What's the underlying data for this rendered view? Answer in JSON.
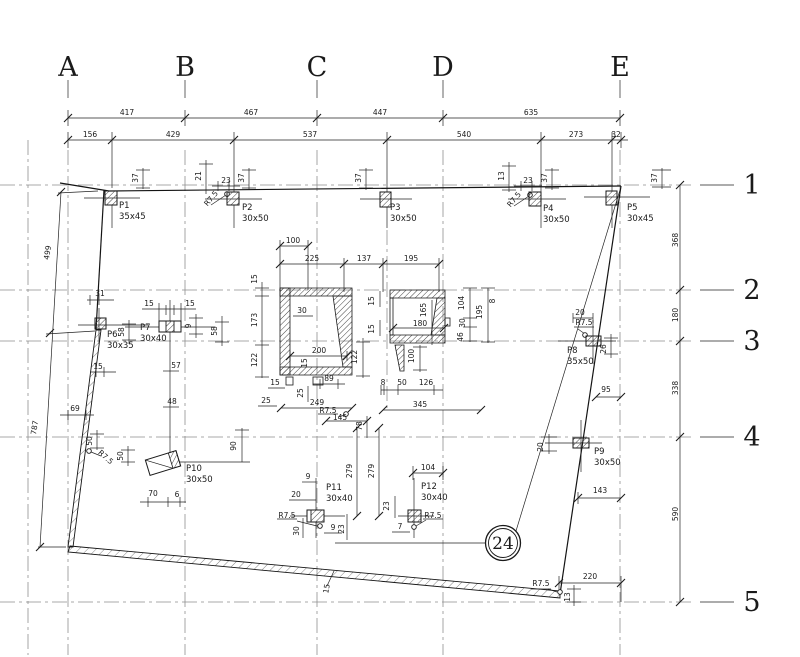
{
  "sheet": {
    "type_label": "structural column layout plan"
  },
  "grid": {
    "columns": [
      {
        "label": "A",
        "x": 68
      },
      {
        "label": "B",
        "x": 185
      },
      {
        "label": "C",
        "x": 317
      },
      {
        "label": "D",
        "x": 443
      },
      {
        "label": "E",
        "x": 620
      }
    ],
    "rows": [
      {
        "label": "1",
        "y": 185
      },
      {
        "label": "2",
        "y": 290
      },
      {
        "label": "3",
        "y": 341
      },
      {
        "label": "4",
        "y": 437
      },
      {
        "label": "5",
        "y": 602
      }
    ]
  },
  "detail_marker": {
    "label": "24",
    "x": 503,
    "y": 543
  },
  "columns": [
    {
      "id": "P1",
      "size": "35x45",
      "x": 119,
      "y": 208
    },
    {
      "id": "P2",
      "size": "30x50",
      "x": 242,
      "y": 210
    },
    {
      "id": "P3",
      "size": "30x50",
      "x": 390,
      "y": 210
    },
    {
      "id": "P4",
      "size": "30x50",
      "x": 543,
      "y": 211
    },
    {
      "id": "P5",
      "size": "30x45",
      "x": 627,
      "y": 210
    },
    {
      "id": "P6",
      "size": "30x35",
      "x": 107,
      "y": 337
    },
    {
      "id": "P7",
      "size": "30x40",
      "x": 140,
      "y": 330
    },
    {
      "id": "P8",
      "size": "35x50",
      "x": 567,
      "y": 353
    },
    {
      "id": "P9",
      "size": "30x50",
      "x": 594,
      "y": 454
    },
    {
      "id": "P10",
      "size": "30x50",
      "x": 186,
      "y": 471
    },
    {
      "id": "P11",
      "size": "30x40",
      "x": 326,
      "y": 490
    },
    {
      "id": "P12",
      "size": "30x40",
      "x": 421,
      "y": 489
    }
  ],
  "dim_labels": [
    {
      "t": "417",
      "x": 127,
      "y": 115
    },
    {
      "t": "467",
      "x": 251,
      "y": 115
    },
    {
      "t": "447",
      "x": 380,
      "y": 115
    },
    {
      "t": "635",
      "x": 531,
      "y": 115
    },
    {
      "t": "156",
      "x": 90,
      "y": 137
    },
    {
      "t": "429",
      "x": 173,
      "y": 137
    },
    {
      "t": "537",
      "x": 310,
      "y": 137
    },
    {
      "t": "540",
      "x": 464,
      "y": 137
    },
    {
      "t": "273",
      "x": 576,
      "y": 137
    },
    {
      "t": "32",
      "x": 616,
      "y": 137
    },
    {
      "t": "37",
      "x": 138,
      "y": 178,
      "r": -90
    },
    {
      "t": "21",
      "x": 201,
      "y": 176,
      "r": -90
    },
    {
      "t": "23",
      "x": 226,
      "y": 183
    },
    {
      "t": "R7.5",
      "x": 213,
      "y": 200,
      "r": -50
    },
    {
      "t": "37",
      "x": 244,
      "y": 178,
      "r": -90
    },
    {
      "t": "37",
      "x": 361,
      "y": 178,
      "r": -90
    },
    {
      "t": "13",
      "x": 504,
      "y": 176,
      "r": -90
    },
    {
      "t": "23",
      "x": 528,
      "y": 183
    },
    {
      "t": "R7.5",
      "x": 516,
      "y": 201,
      "r": -50
    },
    {
      "t": "37",
      "x": 547,
      "y": 178,
      "r": -90
    },
    {
      "t": "37",
      "x": 657,
      "y": 178,
      "r": -90
    },
    {
      "t": "499",
      "x": 50,
      "y": 253,
      "r": -81
    },
    {
      "t": "787",
      "x": 37,
      "y": 428,
      "r": -81
    },
    {
      "t": "31",
      "x": 100,
      "y": 296
    },
    {
      "t": "58",
      "x": 124,
      "y": 332,
      "r": -90
    },
    {
      "t": "15",
      "x": 149,
      "y": 306
    },
    {
      "t": "15",
      "x": 190,
      "y": 306
    },
    {
      "t": "9",
      "x": 191,
      "y": 326,
      "r": -90
    },
    {
      "t": "58",
      "x": 217,
      "y": 331,
      "r": -90
    },
    {
      "t": "57",
      "x": 176,
      "y": 368
    },
    {
      "t": "48",
      "x": 172,
      "y": 404
    },
    {
      "t": "15",
      "x": 98,
      "y": 369
    },
    {
      "t": "69",
      "x": 75,
      "y": 411
    },
    {
      "t": "50",
      "x": 92,
      "y": 441,
      "r": -90
    },
    {
      "t": "R7.5",
      "x": 104,
      "y": 459,
      "r": 42
    },
    {
      "t": "50",
      "x": 123,
      "y": 456,
      "r": -90
    },
    {
      "t": "90",
      "x": 236,
      "y": 446,
      "r": -90
    },
    {
      "t": "70",
      "x": 153,
      "y": 496
    },
    {
      "t": "6",
      "x": 177,
      "y": 497
    },
    {
      "t": "100",
      "x": 293,
      "y": 243
    },
    {
      "t": "225",
      "x": 312,
      "y": 261
    },
    {
      "t": "137",
      "x": 364,
      "y": 261
    },
    {
      "t": "195",
      "x": 411,
      "y": 261
    },
    {
      "t": "15",
      "x": 257,
      "y": 279,
      "r": -90
    },
    {
      "t": "173",
      "x": 257,
      "y": 320,
      "r": -90
    },
    {
      "t": "122",
      "x": 257,
      "y": 360,
      "r": -90
    },
    {
      "t": "30",
      "x": 302,
      "y": 313
    },
    {
      "t": "200",
      "x": 319,
      "y": 353
    },
    {
      "t": "15",
      "x": 307,
      "y": 363,
      "r": -90
    },
    {
      "t": "122",
      "x": 357,
      "y": 357,
      "r": -90
    },
    {
      "t": "89",
      "x": 329,
      "y": 381
    },
    {
      "t": "15",
      "x": 275,
      "y": 385
    },
    {
      "t": "25",
      "x": 303,
      "y": 393,
      "r": -90
    },
    {
      "t": "25",
      "x": 266,
      "y": 403
    },
    {
      "t": "249",
      "x": 317,
      "y": 405
    },
    {
      "t": "R7.5",
      "x": 328,
      "y": 413
    },
    {
      "t": "145",
      "x": 340,
      "y": 420
    },
    {
      "t": "78",
      "x": 362,
      "y": 426,
      "r": -90
    },
    {
      "t": "345",
      "x": 420,
      "y": 407
    },
    {
      "t": "279",
      "x": 352,
      "y": 471,
      "r": -90
    },
    {
      "t": "279",
      "x": 374,
      "y": 471,
      "r": -90
    },
    {
      "t": "15",
      "x": 374,
      "y": 301,
      "r": -90
    },
    {
      "t": "15",
      "x": 374,
      "y": 329,
      "r": -90
    },
    {
      "t": "165",
      "x": 426,
      "y": 310,
      "r": -90
    },
    {
      "t": "180",
      "x": 420,
      "y": 326
    },
    {
      "t": "104",
      "x": 464,
      "y": 303,
      "r": -90
    },
    {
      "t": "195",
      "x": 482,
      "y": 312,
      "r": -90
    },
    {
      "t": "8",
      "x": 495,
      "y": 301,
      "r": -90
    },
    {
      "t": "30",
      "x": 465,
      "y": 323,
      "r": -90
    },
    {
      "t": "46",
      "x": 463,
      "y": 337,
      "r": -90
    },
    {
      "t": "100",
      "x": 414,
      "y": 356,
      "r": -90
    },
    {
      "t": "8",
      "x": 383,
      "y": 385
    },
    {
      "t": "50",
      "x": 402,
      "y": 385
    },
    {
      "t": "126",
      "x": 426,
      "y": 385
    },
    {
      "t": "9",
      "x": 308,
      "y": 479
    },
    {
      "t": "20",
      "x": 296,
      "y": 497
    },
    {
      "t": "R7.5",
      "x": 287,
      "y": 518
    },
    {
      "t": "30",
      "x": 299,
      "y": 531,
      "r": -90
    },
    {
      "t": "9",
      "x": 333,
      "y": 530
    },
    {
      "t": "23",
      "x": 344,
      "y": 529,
      "r": -90
    },
    {
      "t": "104",
      "x": 428,
      "y": 470
    },
    {
      "t": "23",
      "x": 389,
      "y": 506,
      "r": -90
    },
    {
      "t": "7",
      "x": 400,
      "y": 529
    },
    {
      "t": "R7.5",
      "x": 433,
      "y": 518
    },
    {
      "t": "20",
      "x": 580,
      "y": 315
    },
    {
      "t": "R7.5",
      "x": 584,
      "y": 325
    },
    {
      "t": "26",
      "x": 606,
      "y": 349,
      "r": -90
    },
    {
      "t": "95",
      "x": 606,
      "y": 392
    },
    {
      "t": "20",
      "x": 543,
      "y": 447,
      "r": -90
    },
    {
      "t": "143",
      "x": 600,
      "y": 493
    },
    {
      "t": "368",
      "x": 678,
      "y": 240,
      "r": -90
    },
    {
      "t": "180",
      "x": 678,
      "y": 315,
      "r": -90
    },
    {
      "t": "338",
      "x": 678,
      "y": 388,
      "r": -90
    },
    {
      "t": "590",
      "x": 678,
      "y": 514,
      "r": -90
    },
    {
      "t": "220",
      "x": 590,
      "y": 579
    },
    {
      "t": "R7.5",
      "x": 541,
      "y": 586
    },
    {
      "t": "13",
      "x": 570,
      "y": 597,
      "r": -90
    },
    {
      "t": "15",
      "x": 329,
      "y": 589,
      "r": -80
    }
  ]
}
